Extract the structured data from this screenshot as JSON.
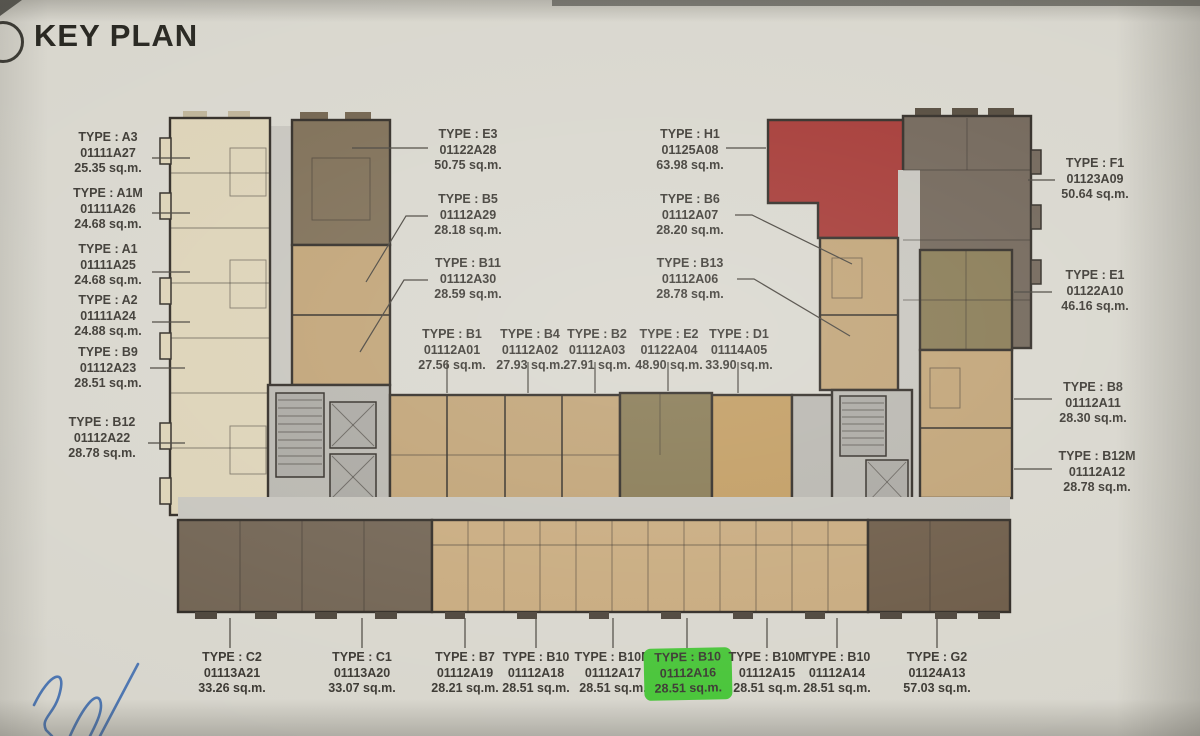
{
  "title": "KEY PLAN",
  "colors": {
    "paper": "#d8d6cd",
    "ink": "#3a3731",
    "title-ink": "#26251f",
    "wall": "#2d2822",
    "cream": "#dcd2b6",
    "tan": "#bfa173",
    "tan-gold": "#c09a5e",
    "tan-light": "#c7a97c",
    "brown": "#7b6b52",
    "dark-taupe": "#6e6255",
    "olive": "#857750",
    "dark-brown": "#6f6150",
    "espresso": "#6a5844",
    "corridor": "#c6c4bd",
    "core-gray": "#b7b5ae",
    "core-dark": "#a8a6a0",
    "red-unit": "#a33531",
    "highlight-green": "#46c436",
    "pen-blue": "#3f6cae"
  },
  "highlighted_unit": {
    "type": "TYPE : B10",
    "code": "01112A16",
    "area": "28.51 sq.m."
  },
  "labels": [
    {
      "type": "TYPE : A3",
      "code": "01111A27",
      "area": "25.35 sq.m."
    },
    {
      "type": "TYPE : A1M",
      "code": "01111A26",
      "area": "24.68 sq.m."
    },
    {
      "type": "TYPE : A1",
      "code": "01111A25",
      "area": "24.68 sq.m."
    },
    {
      "type": "TYPE : A2",
      "code": "01111A24",
      "area": "24.88 sq.m."
    },
    {
      "type": "TYPE : B9",
      "code": "01112A23",
      "area": "28.51 sq.m."
    },
    {
      "type": "TYPE : B12",
      "code": "01112A22",
      "area": "28.78 sq.m."
    },
    {
      "type": "TYPE : E3",
      "code": "01122A28",
      "area": "50.75 sq.m."
    },
    {
      "type": "TYPE : B5",
      "code": "01112A29",
      "area": "28.18 sq.m."
    },
    {
      "type": "TYPE : B11",
      "code": "01112A30",
      "area": "28.59 sq.m."
    },
    {
      "type": "TYPE : B1",
      "code": "01112A01",
      "area": "27.56 sq.m."
    },
    {
      "type": "TYPE : B4",
      "code": "01112A02",
      "area": "27.93 sq.m."
    },
    {
      "type": "TYPE : B2",
      "code": "01112A03",
      "area": "27.91 sq.m."
    },
    {
      "type": "TYPE : E2",
      "code": "01122A04",
      "area": "48.90 sq.m."
    },
    {
      "type": "TYPE : D1",
      "code": "01114A05",
      "area": "33.90 sq.m."
    },
    {
      "type": "TYPE : H1",
      "code": "01125A08",
      "area": "63.98 sq.m."
    },
    {
      "type": "TYPE : B6",
      "code": "01112A07",
      "area": "28.20 sq.m."
    },
    {
      "type": "TYPE : B13",
      "code": "01112A06",
      "area": "28.78 sq.m."
    },
    {
      "type": "TYPE : F1",
      "code": "01123A09",
      "area": "50.64 sq.m."
    },
    {
      "type": "TYPE : E1",
      "code": "01122A10",
      "area": "46.16 sq.m."
    },
    {
      "type": "TYPE : B8",
      "code": "01112A11",
      "area": "28.30 sq.m."
    },
    {
      "type": "TYPE : B12M",
      "code": "01112A12",
      "area": "28.78 sq.m."
    },
    {
      "type": "TYPE : C2",
      "code": "01113A21",
      "area": "33.26 sq.m."
    },
    {
      "type": "TYPE : C1",
      "code": "01113A20",
      "area": "33.07 sq.m."
    },
    {
      "type": "TYPE : B7",
      "code": "01112A19",
      "area": "28.21 sq.m."
    },
    {
      "type": "TYPE : B10",
      "code": "01112A18",
      "area": "28.51 sq.m."
    },
    {
      "type": "TYPE : B10M",
      "code": "01112A17",
      "area": "28.51 sq.m."
    },
    {
      "type": "TYPE : B10",
      "code": "01112A16",
      "area": "28.51 sq.m."
    },
    {
      "type": "TYPE : B10M",
      "code": "01112A15",
      "area": "28.51 sq.m."
    },
    {
      "type": "TYPE : B10",
      "code": "01112A14",
      "area": "28.51 sq.m."
    },
    {
      "type": "TYPE : G2",
      "code": "01124A13",
      "area": "57.03 sq.m."
    }
  ]
}
